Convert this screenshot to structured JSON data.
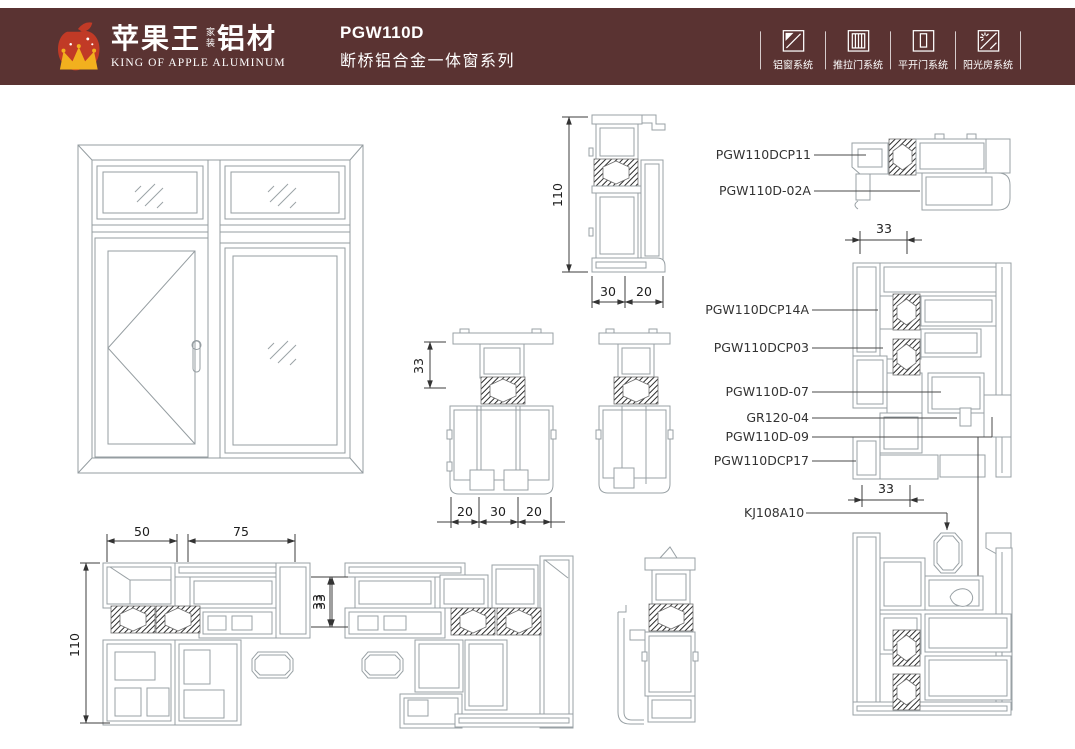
{
  "header": {
    "bg_color": "#5a3332",
    "brand": {
      "name_cn": "苹果王",
      "tag_cn": "家装",
      "material_cn": "铝材",
      "name_en": "KING OF APPLE ALUMINUM",
      "apple_color": "#c13a26",
      "crown_color": "#f2b01e"
    },
    "title": {
      "model": "PGW110D",
      "series": "断桥铝合金一体窗系列"
    },
    "systems": [
      {
        "icon": "aluminum-window-icon",
        "label": "铝窗系统"
      },
      {
        "icon": "sliding-door-icon",
        "label": "推拉门系统"
      },
      {
        "icon": "casement-door-icon",
        "label": "平开门系统"
      },
      {
        "icon": "sunroom-icon",
        "label": "阳光房系统"
      }
    ]
  },
  "drawing": {
    "line_color": "#99a1a5",
    "dim_color": "#3c3c3c",
    "dims": {
      "d110": "110",
      "d50": "50",
      "d75": "75",
      "d33": "33",
      "d30": "30",
      "d20": "20"
    },
    "labels": {
      "p11": "PGW110DCP11",
      "p02a": "PGW110D-02A",
      "p14a": "PGW110DCP14A",
      "p03": "PGW110DCP03",
      "p07": "PGW110D-07",
      "gr": "GR120-04",
      "p09": "PGW110D-09",
      "p17": "PGW110DCP17",
      "kj": "KJ108A10"
    }
  }
}
